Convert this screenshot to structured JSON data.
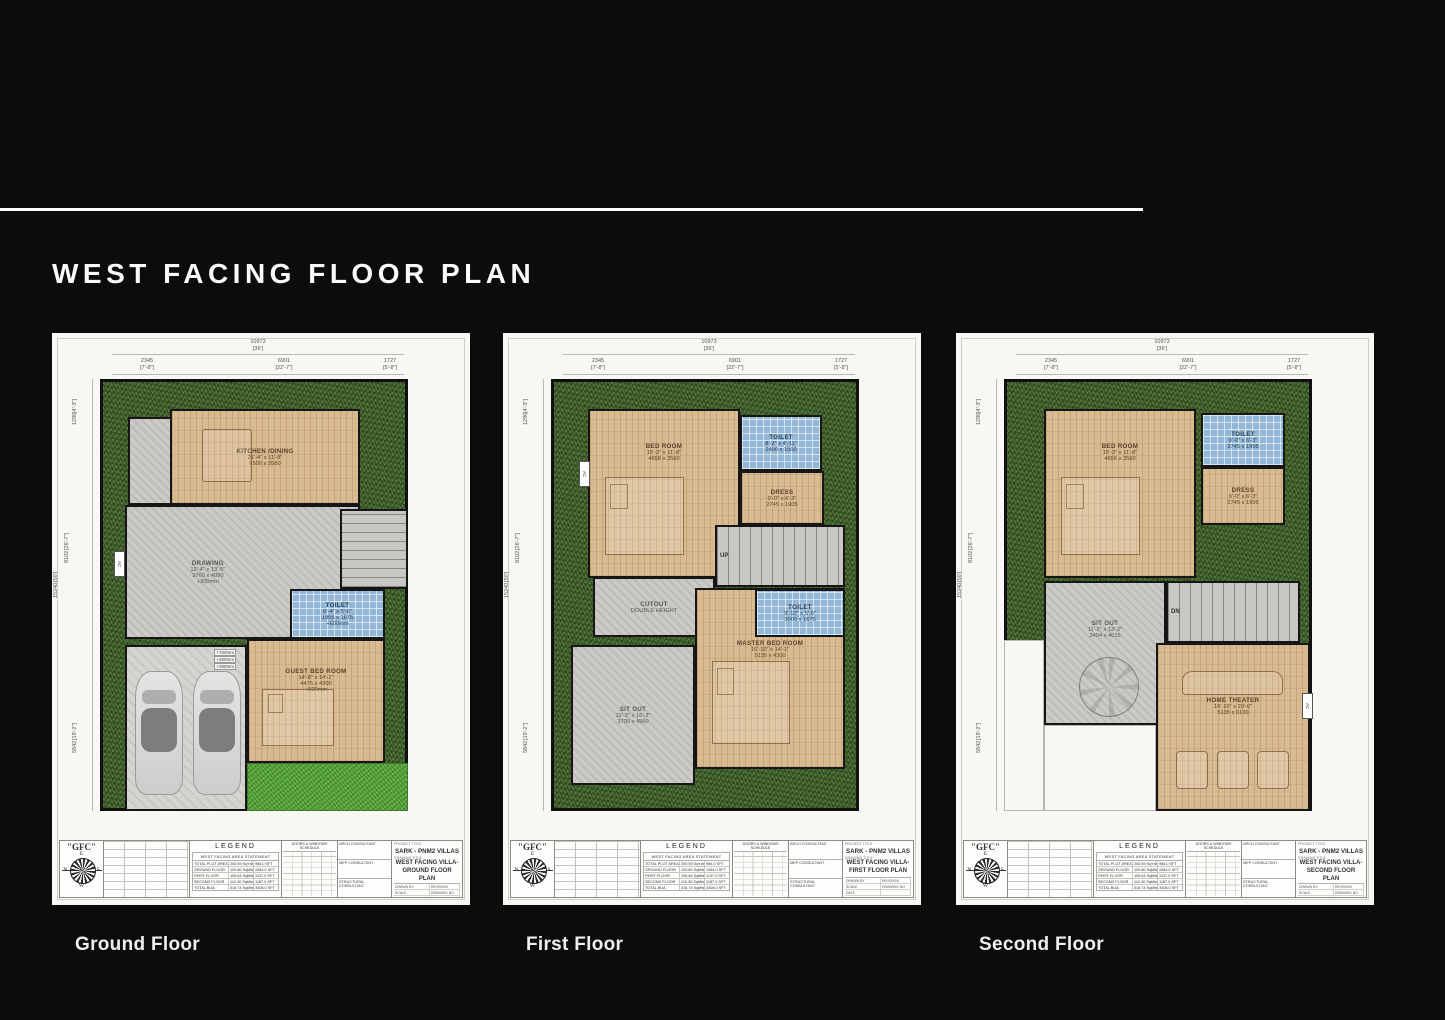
{
  "page": {
    "title": "WEST FACING FLOOR PLAN"
  },
  "colors": {
    "background": "#0d0b0c",
    "sheet": "#f8f7f4",
    "grass": "#47682f",
    "lawn": "#55a23a",
    "wood": "#d9bb92",
    "tile": "#93b7d6",
    "concrete": "#cbcac6"
  },
  "dimensions": {
    "top_total_mm": "10973",
    "top_total_ft": "[36']",
    "top_segments": [
      {
        "mm": "2345",
        "ft": "[7'-8\"]"
      },
      {
        "mm": "6901",
        "ft": "[22'-7\"]"
      },
      {
        "mm": "1727",
        "ft": "[5'-8\"]"
      }
    ],
    "left_segments": [
      {
        "mm": "1296",
        "ft": "[4'-3\"]"
      },
      {
        "mm": "8102",
        "ft": "[26'-7\"]"
      },
      {
        "mm": "15240",
        "ft": "[50']"
      },
      {
        "mm": "5842",
        "ft": "[19'-2\"]"
      }
    ]
  },
  "floors": [
    {
      "caption": "Ground Floor",
      "drawing_title1": "WEST FACING VILLA-",
      "drawing_title2": "GROUND FLOOR PLAN",
      "rooms": [
        {
          "id": "utility",
          "type": "concrete",
          "rect": [
            76,
            84,
            44,
            88
          ]
        },
        {
          "id": "kitchen-dining",
          "type": "wood",
          "label": "KITCHEN /DINING",
          "ft": "21'-4\" x 11'-8\"",
          "mm": "6500 x 3560",
          "rect": [
            118,
            76,
            190,
            96
          ],
          "furn": "table"
        },
        {
          "id": "drawing-hall",
          "type": "concrete",
          "label": "DRAWING",
          "ft": "12'-4\" x 13'-5\"",
          "mm": "3760 x 4090",
          "note": "+300mm",
          "rect": [
            73,
            172,
            235,
            134
          ],
          "lstyle": "padding-right:30%"
        },
        {
          "id": "stairs",
          "type": "stairs",
          "dir": "v",
          "rect": [
            288,
            176,
            68,
            80
          ]
        },
        {
          "id": "porch",
          "type": "porch",
          "rect": [
            73,
            312,
            122,
            166
          ],
          "cars": true
        },
        {
          "id": "lawn",
          "type": "lawn",
          "rect": [
            195,
            430,
            161,
            48
          ]
        },
        {
          "id": "guest-bed-room",
          "type": "wood",
          "label": "GUEST BED ROOM",
          "ft": "14'-8\" x 14'-1\"",
          "mm": "4475 x 4300",
          "note": "+600mm",
          "rect": [
            195,
            306,
            138,
            124
          ],
          "furn": "bed",
          "lstyle": "padding-bottom:30%"
        },
        {
          "id": "toilet",
          "type": "tile",
          "label": "TOILET",
          "ft": "6'-4\" x 5'-6\"",
          "mm": "1955 x 1675",
          "note": "+600mm",
          "rect": [
            238,
            256,
            95,
            50
          ]
        },
        {
          "id": "steps-note",
          "type": "note",
          "rect": [
            142,
            316,
            42,
            20
          ],
          "lines": [
            "+750mm",
            "+450mm",
            "+300mm"
          ]
        },
        {
          "id": "ac",
          "type": "actag",
          "label": "AC",
          "rect": [
            62,
            218,
            11,
            26
          ]
        }
      ]
    },
    {
      "caption": "First Floor",
      "drawing_title1": "WEST FACING VILLA-",
      "drawing_title2": "FIRST FLOOR PLAN",
      "rooms": [
        {
          "id": "bed-room",
          "type": "wood",
          "label": "BED ROOM",
          "ft": "15'-3\" x 11'-8\"",
          "mm": "4658 x 3560",
          "rect": [
            85,
            76,
            152,
            169
          ],
          "furn": "bed",
          "lstyle": "padding-bottom:55%"
        },
        {
          "id": "toilet",
          "type": "tile",
          "label": "TOILET",
          "ft": "8'-2\" x 4'-11\"",
          "mm": "2490 x 1500",
          "rect": [
            237,
            82,
            82,
            56
          ]
        },
        {
          "id": "dress",
          "type": "wood",
          "label": "DRESS",
          "ft": "9'-0\" x 6'-3\"",
          "mm": "2745 x 1905",
          "rect": [
            237,
            138,
            84,
            54
          ]
        },
        {
          "id": "stairs-up",
          "type": "stairs",
          "label": "UP",
          "rect": [
            212,
            192,
            130,
            62
          ]
        },
        {
          "id": "cutout",
          "type": "concrete",
          "label": "CUTOUT",
          "ft": "DOUBLE HEIGHT",
          "rect": [
            90,
            244,
            122,
            60
          ]
        },
        {
          "id": "master-bed-room",
          "type": "wood",
          "label": "MASTER BED ROOM",
          "ft": "16'-10\" x 14'-1\"",
          "mm": "5135 x 4300",
          "rect": [
            192,
            255,
            150,
            181
          ],
          "furn": "bed",
          "lstyle": "padding-bottom:40%"
        },
        {
          "id": "toilet-2",
          "type": "tile",
          "label": "TOILET",
          "ft": "9'-10\" x 5'-6\"",
          "mm": "3000 x 1675",
          "rect": [
            252,
            256,
            90,
            48
          ]
        },
        {
          "id": "sit-out",
          "type": "concrete",
          "label": "SIT OUT",
          "ft": "12'-2\" x 16'-3\"",
          "mm": "3700 x 4960",
          "rect": [
            68,
            312,
            124,
            140
          ]
        },
        {
          "id": "ac",
          "type": "actag",
          "label": "AC",
          "rect": [
            76,
            128,
            11,
            26
          ]
        }
      ]
    },
    {
      "caption": "Second Floor",
      "drawing_title1": "WEST FACING VILLA-",
      "drawing_title2": "SECOND FLOOR PLAN",
      "rooms": [
        {
          "id": "bed-room",
          "type": "wood",
          "label": "BED ROOM",
          "ft": "15'-3\" x 11'-8\"",
          "mm": "4656 x 3560",
          "rect": [
            88,
            76,
            152,
            169
          ],
          "furn": "bed",
          "lstyle": "padding-bottom:55%"
        },
        {
          "id": "toilet",
          "type": "tile",
          "label": "TOILET",
          "ft": "9'-0\" x 6'-3\"",
          "mm": "2745 x 1905",
          "rect": [
            245,
            80,
            84,
            54
          ]
        },
        {
          "id": "dress",
          "type": "wood",
          "label": "DRESS",
          "ft": "9'-0\" x 6'-3\"",
          "mm": "2745 x 1905",
          "rect": [
            245,
            134,
            84,
            58
          ]
        },
        {
          "id": "open-1",
          "type": "open",
          "rect": [
            48,
            307,
            40,
            171
          ]
        },
        {
          "id": "open-2",
          "type": "open",
          "rect": [
            88,
            392,
            112,
            86
          ]
        },
        {
          "id": "sit-out",
          "type": "concrete",
          "label": "SIT OUT",
          "ft": "11'-2\" x 13'-2\"",
          "mm": "3404 x 4015",
          "rect": [
            88,
            248,
            122,
            144
          ],
          "furn": "mandala",
          "lstyle": "padding-bottom:40%"
        },
        {
          "id": "stairs-dn",
          "type": "stairs",
          "label": "DN",
          "rect": [
            210,
            248,
            134,
            62
          ]
        },
        {
          "id": "home-theater",
          "type": "wood",
          "label": "HOME THEATER",
          "ft": "16'-10\" x 20'-0\"",
          "mm": "5135 x 6100",
          "rect": [
            200,
            310,
            154,
            168
          ],
          "furn": "recliners",
          "lstyle": "padding-bottom:28%"
        },
        {
          "id": "ac",
          "type": "actag",
          "label": "AC",
          "rect": [
            346,
            360,
            11,
            26
          ]
        }
      ]
    }
  ],
  "titleblock": {
    "logo": "\"GFC\"",
    "compass": {
      "top": "E",
      "left": "N",
      "right": "S",
      "bottom": "W"
    },
    "legend_title": "LEGEND",
    "area_statement": {
      "title": "WEST FACING AREA STATEMENT",
      "rows": [
        [
          "TOTAL PLOT AREA",
          "200.59 SqYds",
          "966.0 SFT"
        ],
        [
          "GROUND FLOOR",
          "100.80 SqMts",
          "1084.0 SFT"
        ],
        [
          "FIRST FLOOR",
          "105.64 SqMts",
          "1137.0 SFT"
        ],
        [
          "SECOND FLOOR",
          "110.30 SqMts",
          "1187.0 SFT"
        ],
        [
          "TOTAL BUA",
          "316.74 SqMts",
          "3408.0 SFT"
        ]
      ]
    },
    "schedule_title": "DOORS & WINDOWS SCHEDULE",
    "consultants": [
      "ARCH CONSULTANT",
      "MEP CONSULTANT",
      "STRUCTURAL CONSULTANT"
    ],
    "project_title_label": "PROJECT TITLE",
    "project_title": "SARK - PNM2 VILLAS",
    "drawing_title_label": "DRAWING TITLE",
    "meta_labels": [
      "DRAWN BY",
      "SCALE",
      "DATE"
    ],
    "meta_right": [
      "REVISION",
      "DRAWING NO"
    ]
  }
}
